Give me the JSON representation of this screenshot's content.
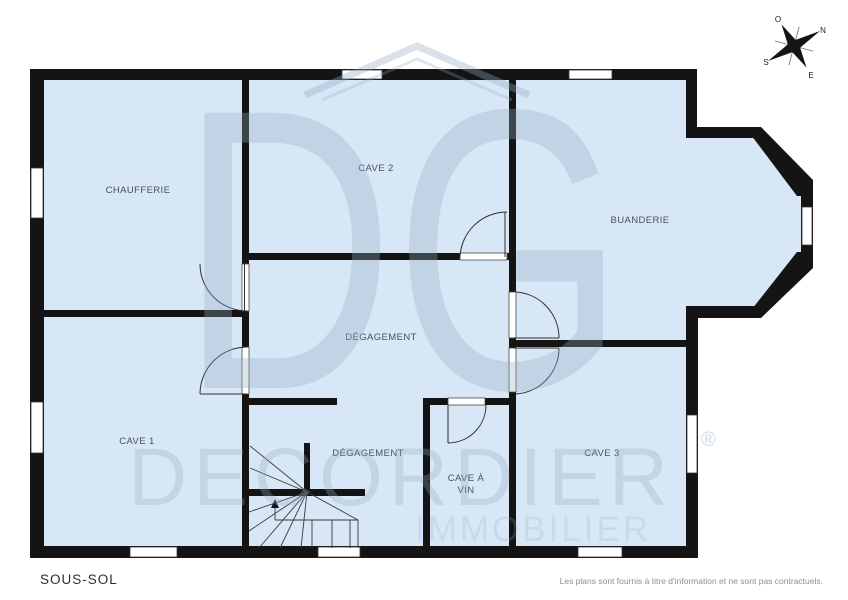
{
  "page": {
    "floor_label": "SOUS-SOL",
    "disclaimer": "Les plans sont fournis à titre d'information et ne sont pas contractuels."
  },
  "plan": {
    "rooms": [
      {
        "id": "chaufferie",
        "label": "CHAUFFERIE"
      },
      {
        "id": "cave-2",
        "label": "CAVE 2"
      },
      {
        "id": "buanderie",
        "label": "BUANDERIE"
      },
      {
        "id": "degagement-haut",
        "label": "DÉGAGEMENT"
      },
      {
        "id": "cave-1",
        "label": "CAVE 1"
      },
      {
        "id": "degagement-bas",
        "label": "DÉGAGEMENT"
      },
      {
        "id": "cave-a-vin",
        "label_line1": "CAVE À",
        "label_line2": "VIN"
      },
      {
        "id": "cave-3",
        "label": "CAVE 3"
      }
    ],
    "compass": {
      "north": "N",
      "south": "S",
      "east": "E",
      "west": "O"
    },
    "watermark": {
      "monogram": "DG",
      "brand": "DECORDIER",
      "registered": "®",
      "subtitle": "IMMOBILIER"
    },
    "colors": {
      "floor": "#d8e7f6",
      "wall": "#141414",
      "label": "#47525e",
      "watermark_tint": "#91aac3"
    }
  }
}
